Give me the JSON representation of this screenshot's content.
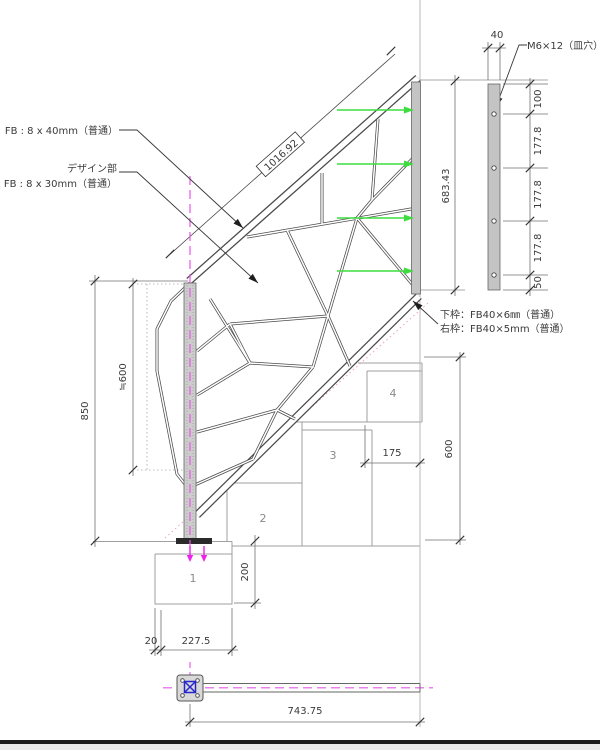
{
  "drawing": {
    "labels": {
      "fb_40": "FB : 8 x 40mm（普通）",
      "design_part": "デザイン部",
      "fb_30": "FB : 8 x 30mm（普通）",
      "screw": "M6×12（皿穴）",
      "bottom_frame": "下枠：FB40×6㎜（普通）",
      "right_frame": "右枠：FB40×5mm（普通）"
    },
    "dimensions": {
      "rail_length": "1016.92",
      "panel_height": "683.43",
      "plate_width": "40",
      "plate_spacings": [
        "100",
        "177.8",
        "177.8",
        "177.8",
        "50"
      ],
      "post_height": "850",
      "design_height": "≒600",
      "foundation_height": "200",
      "foundation_offset": "20",
      "foundation_width": "227.5",
      "tread_depth": "175",
      "stair_height": "600",
      "plan_length": "743.75"
    },
    "steps": [
      "1",
      "2",
      "3",
      "4"
    ],
    "colors": {
      "accent_green": "#3ddd3d",
      "accent_magenta": "#e855e8",
      "accent_blue": "#2626cc",
      "nosing_pink": "#f0a0c8"
    }
  }
}
